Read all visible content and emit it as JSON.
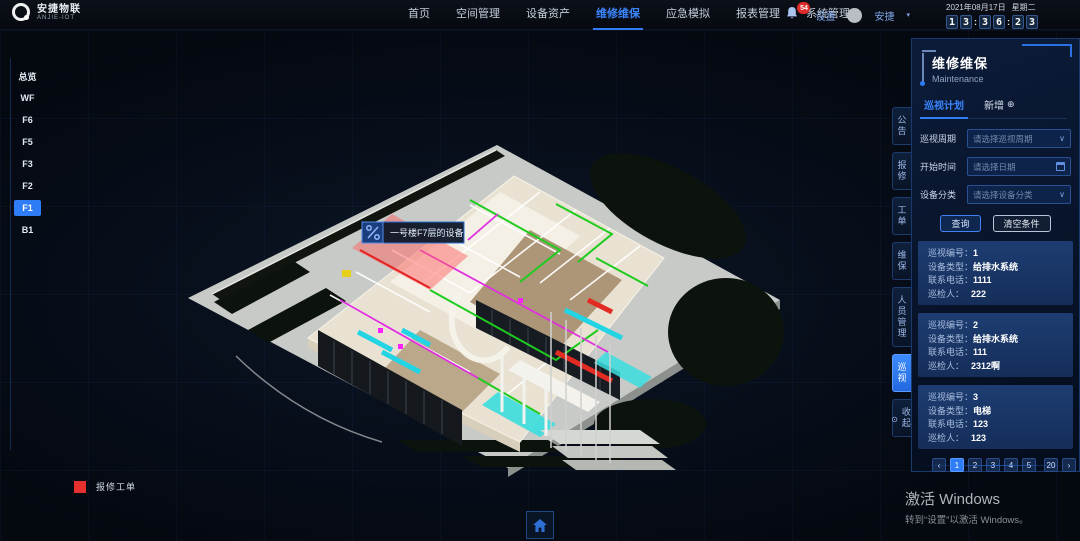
{
  "brand": {
    "name": "安捷物联",
    "sub": "ANJIE-IOT"
  },
  "topnav": {
    "items": [
      "首页",
      "空间管理",
      "设备资产",
      "维修维保",
      "应急模拟",
      "报表管理",
      "系统管理"
    ]
  },
  "topbar": {
    "badge": "54",
    "settings": "设置",
    "user": "安捷",
    "caret": "▾",
    "date": "2021年08月17日",
    "weekday": "星期二",
    "time_digits": [
      "1",
      "3",
      "3",
      "6",
      "2",
      "3"
    ],
    "colon": ":"
  },
  "floors": {
    "items": [
      "总览",
      "WF",
      "F6",
      "F5",
      "F3",
      "F2",
      "F1",
      "B1"
    ],
    "active": "F1"
  },
  "model": {
    "tooltip": "一号楼F7层的设备"
  },
  "legend": {
    "label": "报修工单",
    "color": "#e8312f"
  },
  "side_tabs": {
    "items": [
      "公告",
      "报修",
      "工单",
      "维保",
      "人员管理",
      "巡视"
    ],
    "active": "巡视",
    "collapse": "收起",
    "collapse_icon": "⊙"
  },
  "panel": {
    "title": "维修维保",
    "subtitle": "Maintenance",
    "tab_plan": "巡视计划",
    "tab_add": "新增",
    "add_icon": "⊕",
    "form": {
      "period_label": "巡视周期",
      "period_placeholder": "请选择巡视周期",
      "start_label": "开始时间",
      "start_placeholder": "请选择日期",
      "category_label": "设备分类",
      "category_placeholder": "请选择设备分类",
      "chevron": "∨"
    },
    "buttons": {
      "query": "查询",
      "clear": "清空条件"
    },
    "card_labels": {
      "no": "巡视编号：",
      "type": "设备类型：",
      "tel": "联系电话：",
      "person": "巡检人："
    },
    "cards": [
      {
        "no": "1",
        "type": "给排水系统",
        "tel": "1111",
        "person": "222"
      },
      {
        "no": "2",
        "type": "给排水系统",
        "tel": "111",
        "person": "2312啊"
      },
      {
        "no": "3",
        "type": "电梯",
        "tel": "123",
        "person": "123"
      }
    ],
    "pagination": {
      "prev": "‹",
      "pages": [
        "1",
        "2",
        "3",
        "4",
        "5"
      ],
      "last": "20",
      "next": "›",
      "active": "1"
    }
  },
  "watermark": {
    "line1": "激活 Windows",
    "line2": "转到“设置”以激活 Windows。"
  }
}
